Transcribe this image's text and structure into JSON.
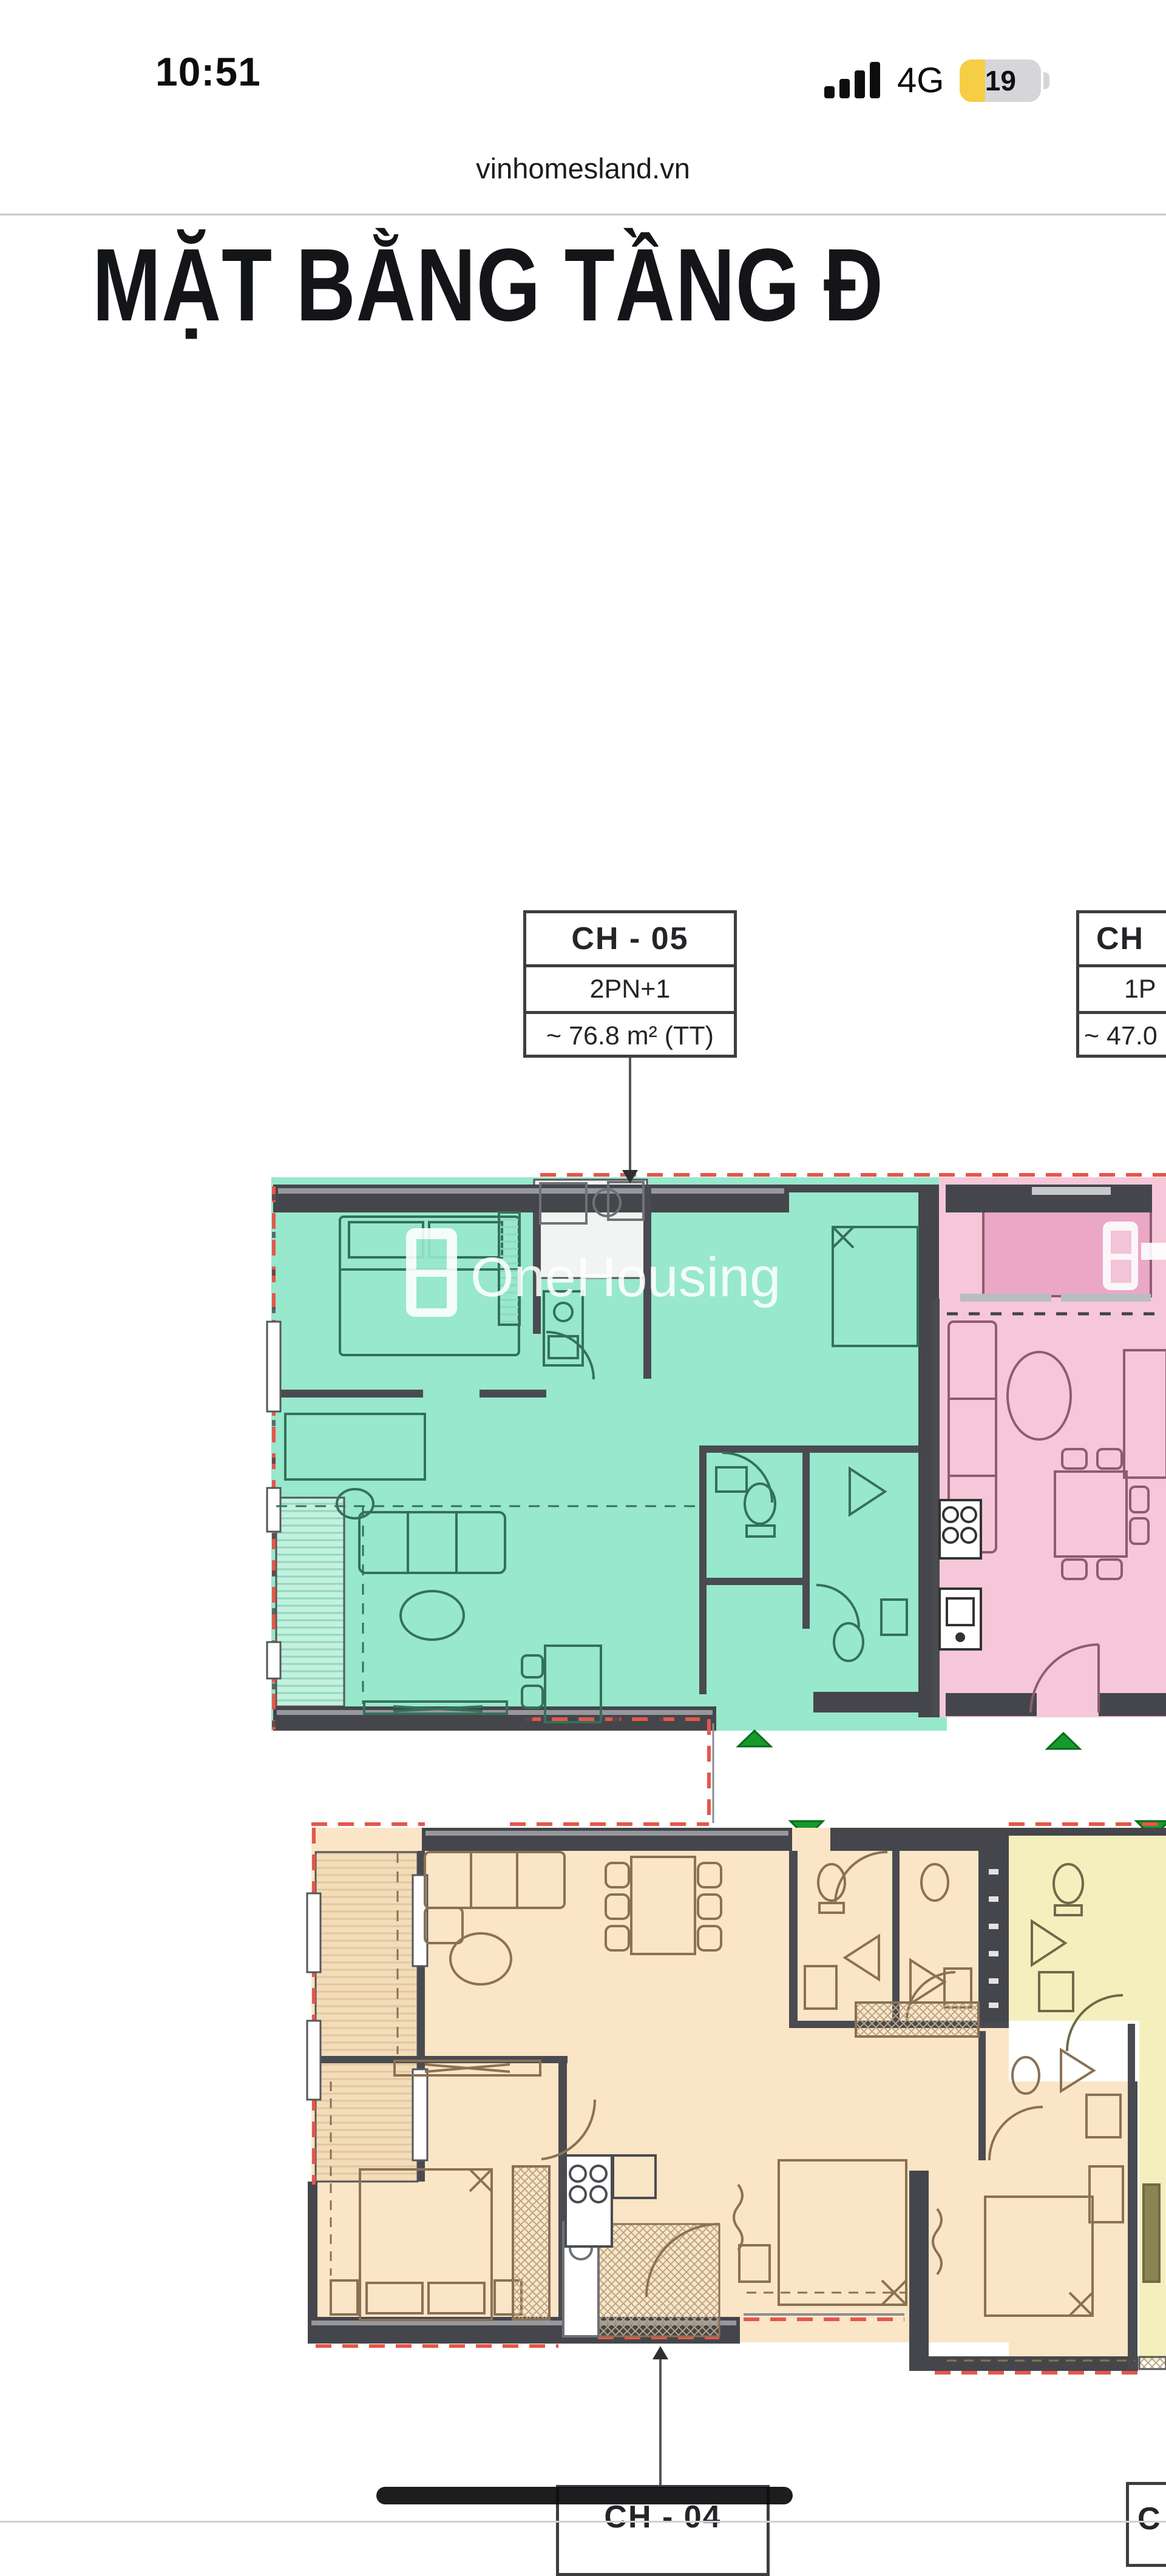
{
  "status_bar": {
    "time": "10:51",
    "network": "4G",
    "battery_percent": "19"
  },
  "browser": {
    "url": "vinhomesland.vn"
  },
  "page": {
    "title": "MẶT BẰNG TẦNG Đ"
  },
  "watermark": {
    "text": "OneHousing"
  },
  "labels": {
    "ch05": {
      "code": "CH - 05",
      "type": "2PN+1",
      "area": "~ 76.8 m² (TT)"
    },
    "ch06_partial": {
      "code": "CH",
      "type": "1P",
      "area": "~ 47.0"
    },
    "ch04": {
      "code": "CH - 04"
    },
    "bottom_right_partial": {
      "code": "C"
    }
  },
  "colors": {
    "teal": "#97e8cc",
    "teal_light": "#c4f0de",
    "teal_stripe": "#8fd9bd",
    "furniture_teal": "#35705a",
    "pink": "#f5c7d9",
    "pink_dark": "#eaa8c5",
    "furniture_pink": "#8f5b71",
    "orange": "#fae5c6",
    "orange_light": "#f3dcba",
    "orange_stripe": "#e2c79e",
    "furniture_orange": "#8a7153",
    "yellow": "#f5efbe",
    "wall": "#45464b",
    "wall_light": "#97989d",
    "red_dash": "#e4574b",
    "green": "#179a2c",
    "green_dark": "#0a6b1a",
    "battery_yellow": "#f6ce45",
    "white": "#ffffff"
  }
}
